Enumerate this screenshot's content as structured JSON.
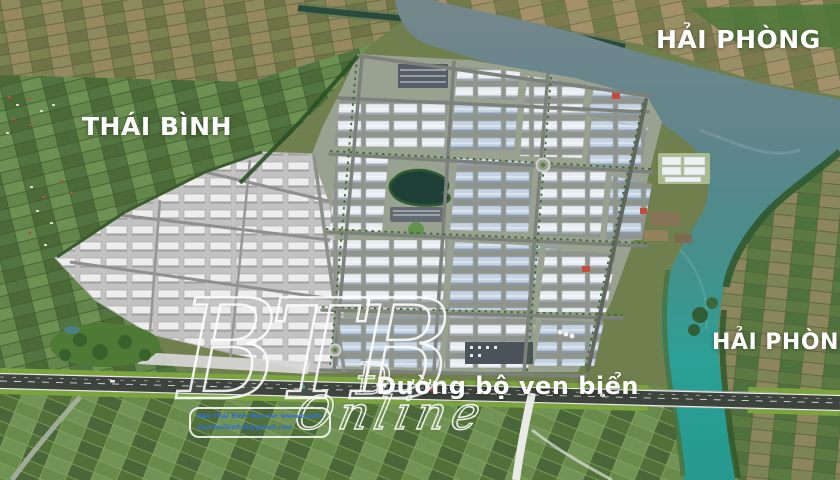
{
  "scene": {
    "region_labels": [
      {
        "id": "thai-binh",
        "text": "THÁI BÌNH"
      },
      {
        "id": "hai-phong-top",
        "text": "HẢI PHÒNG"
      },
      {
        "id": "hai-phong-right",
        "text": "HẢI PHÒNG"
      }
    ],
    "road_label": "Đường bộ ven biển",
    "watermark": {
      "initials": "BTB",
      "d_glyph": "Đ",
      "script": "Online",
      "credit_line1": "Báo Thái Bình điện tử: www.baothaibinh.com.vn",
      "credit_line2": "baothaibinhdt@gmail.com"
    },
    "palette": {
      "river_upper": "#75878c",
      "river_lower": "#27998e",
      "fields_green": "#567741",
      "fields_tan": "#8b815a",
      "highway_asphalt": "#3d433d",
      "label_text": "#ffffff"
    }
  }
}
